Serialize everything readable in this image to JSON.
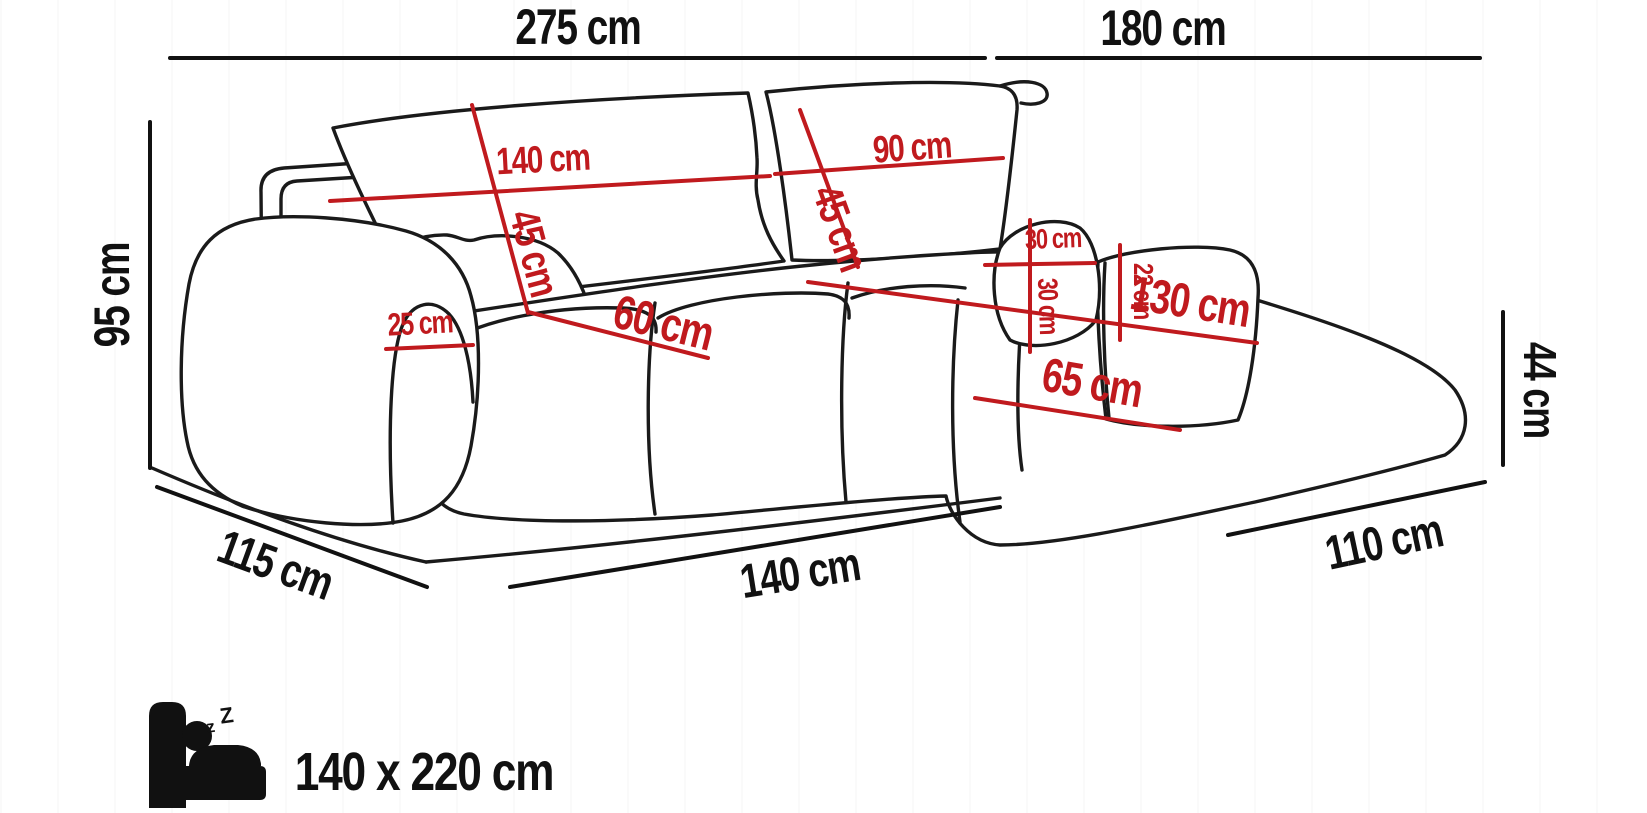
{
  "diagram": {
    "type": "corner-sofa-dimension-diagram",
    "colors": {
      "outline": "#1a1a1a",
      "dimension_black": "#111111",
      "dimension_red": "#c01a1e",
      "background": "#ffffff"
    },
    "overall": {
      "top_left": "275 cm",
      "top_right": "180 cm",
      "height": "95 cm",
      "depth_left": "115 cm",
      "front": "140 cm",
      "chaise": "110 cm",
      "seat_height": "44 cm"
    },
    "details": {
      "back_left_w": "140 cm",
      "back_left_h": "45 cm",
      "back_right_w": "90 cm",
      "back_right_h": "45 cm",
      "armrest_w": "25 cm",
      "seat_depth": "60 cm",
      "chaise_len": "130 cm",
      "chaise_w": "65 cm",
      "pillow_w": "30 cm",
      "pillow_h": "30 cm",
      "armrest_right_h": "22 cm"
    },
    "sleeping": {
      "label": "140 x 220 cm",
      "z_small": "z",
      "z_big": "Z"
    }
  }
}
